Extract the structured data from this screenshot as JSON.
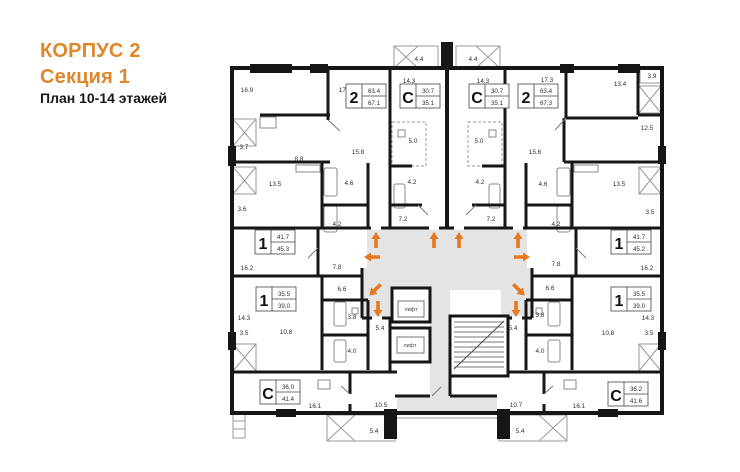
{
  "header": {
    "building": "КОРПУС 2",
    "section": "Секция 1",
    "floors": "План 10-14 этажей"
  },
  "plan": {
    "accent_color": "#E0862B",
    "arrow_color": "#E8781E",
    "wall_color": "#161616",
    "corridor_color": "#e4e4e4",
    "elevator_label": "лифт",
    "apartments": [
      {
        "type": "2",
        "living": "63.4",
        "total": "67.1"
      },
      {
        "type": "С",
        "living": "30.7",
        "total": "35.1"
      },
      {
        "type": "С",
        "living": "30.7",
        "total": "35.1"
      },
      {
        "type": "2",
        "living": "63.4",
        "total": "67.3"
      },
      {
        "type": "1",
        "living": "41.7",
        "total": "45.3"
      },
      {
        "type": "1",
        "living": "41.7",
        "total": "45.2"
      },
      {
        "type": "1",
        "living": "35.5",
        "total": "39.0"
      },
      {
        "type": "1",
        "living": "35.5",
        "total": "39.0"
      },
      {
        "type": "С",
        "living": "36.0",
        "total": "41.4"
      },
      {
        "type": "С",
        "living": "36.2",
        "total": "41.6"
      }
    ],
    "room_labels": [
      "16.9",
      "17.3",
      "4.4",
      "4.4",
      "14.3",
      "14.3",
      "17.3",
      "13.4",
      "3.9",
      "3.7",
      "8.8",
      "15.8",
      "5.0",
      "5.0",
      "15.6",
      "12.5",
      "13.5",
      "4.6",
      "4.2",
      "4.2",
      "4.6",
      "13.5",
      "3.6",
      "4.2",
      "7.2",
      "7.2",
      "4.2",
      "3.5",
      "16.2",
      "7.8",
      "7.8",
      "16.2",
      "6.6",
      "6.6",
      "14.3",
      "3.8",
      "3.8",
      "14.3",
      "3.5",
      "10.8",
      "5.4",
      "5.4",
      "10.8",
      "3.5",
      "4.0",
      "4.0",
      "16.1",
      "10.5",
      "10.7",
      "16.1",
      "5.4",
      "5.4"
    ]
  }
}
